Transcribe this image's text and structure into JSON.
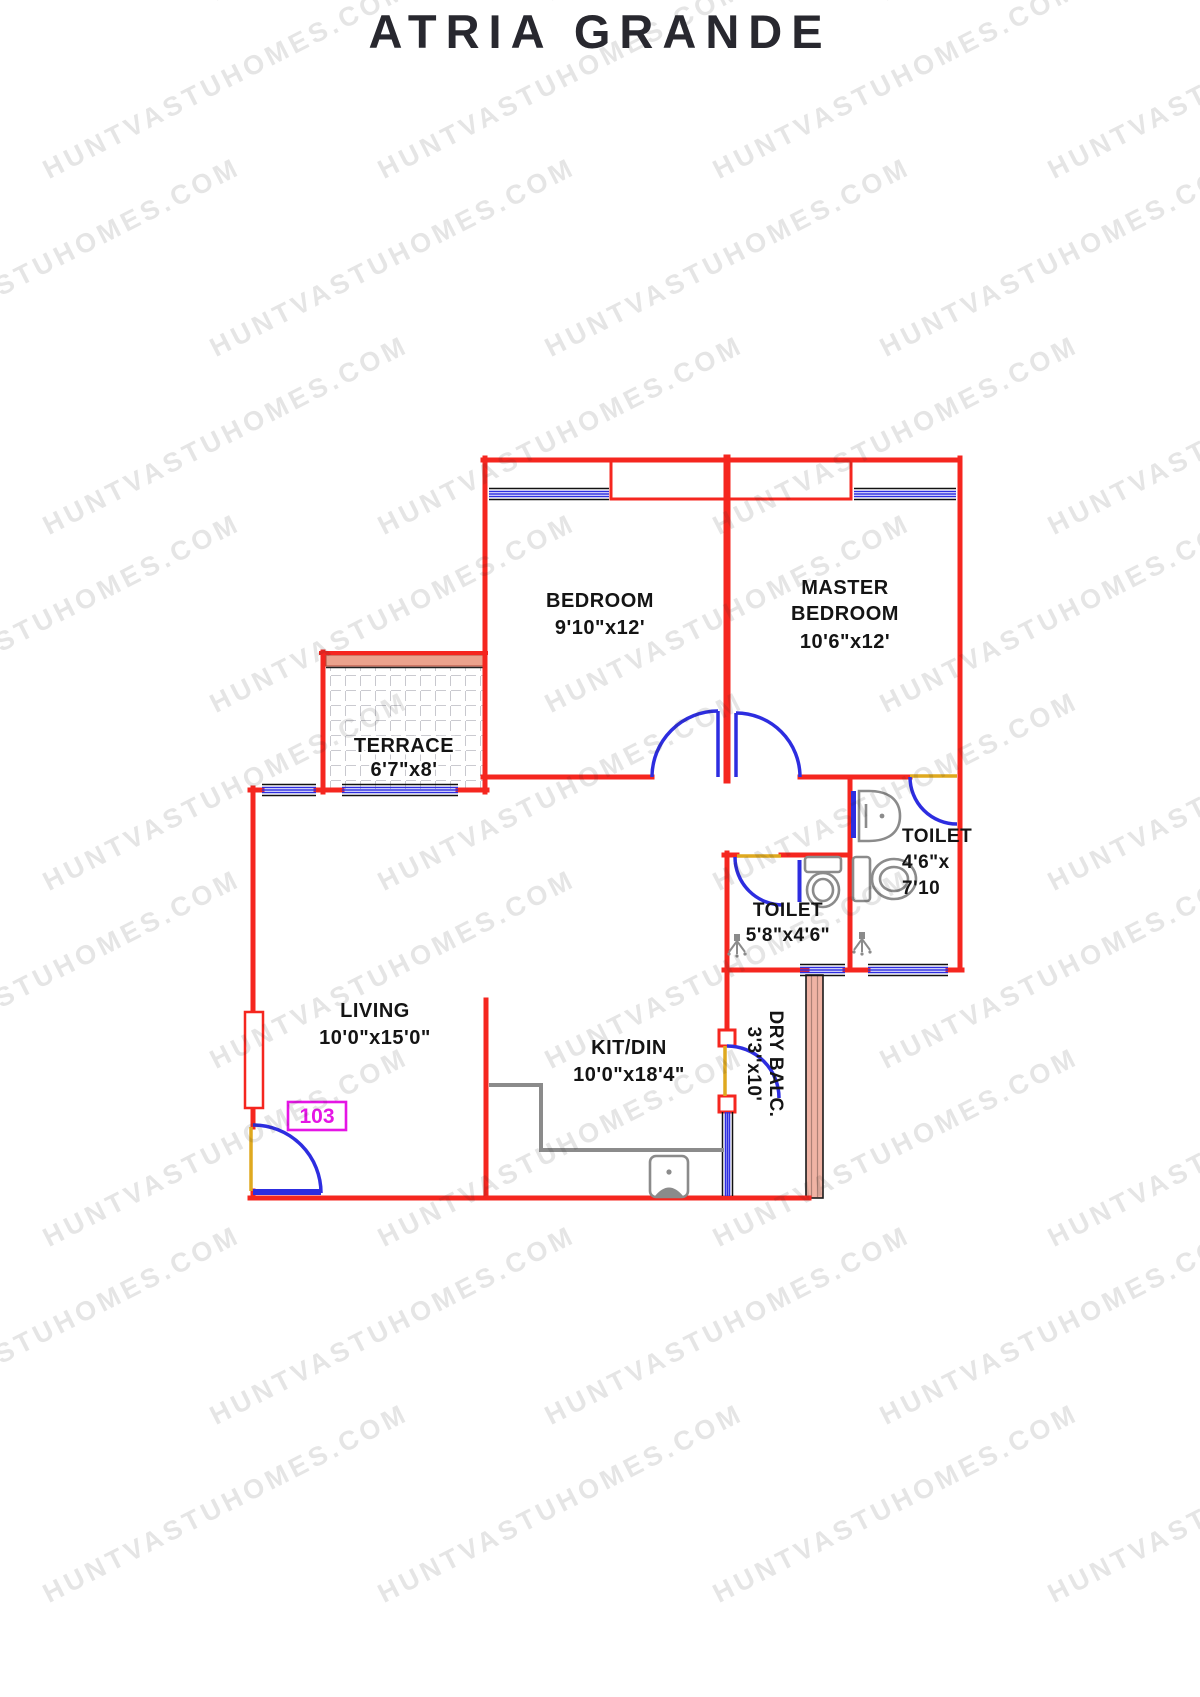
{
  "page": {
    "title": "ATRIA GRANDE",
    "watermark": "HUNTVASTUHOMES.COM"
  },
  "unit": {
    "number": "103"
  },
  "rooms": {
    "bedroom": {
      "name": "BEDROOM",
      "size": "9'10\"x12'"
    },
    "master_bedroom": {
      "name_line1": "MASTER",
      "name_line2": "BEDROOM",
      "size": "10'6\"x12'"
    },
    "terrace": {
      "name": "TERRACE",
      "size": "6'7\"x8'"
    },
    "toilet_common": {
      "name": "TOILET",
      "size": "5'8\"x4'6\""
    },
    "toilet_master": {
      "name": "TOILET",
      "size_line1": "4'6\"x",
      "size_line2": "7'10"
    },
    "living": {
      "name": "LIVING",
      "size": "10'0\"x15'0\""
    },
    "kitchen_dining": {
      "name": "KIT/DIN",
      "size": "10'0\"x18'4\""
    },
    "dry_balcony": {
      "name": "DRY BALC.",
      "size": "3'3\"x10'"
    }
  },
  "colors": {
    "wall": "#f5261f",
    "window": "#2d2de0",
    "door_swing": "#2d2de0",
    "threshold": "#dfa91f",
    "terrace_band": "#eba28d",
    "hatch_wall": "#f0b3a4",
    "fixture": "#8b8b8b",
    "unit_badge": "#e515e5",
    "label_text": "#141414",
    "watermark": "#d9d9d9",
    "title_text": "#28282f"
  }
}
